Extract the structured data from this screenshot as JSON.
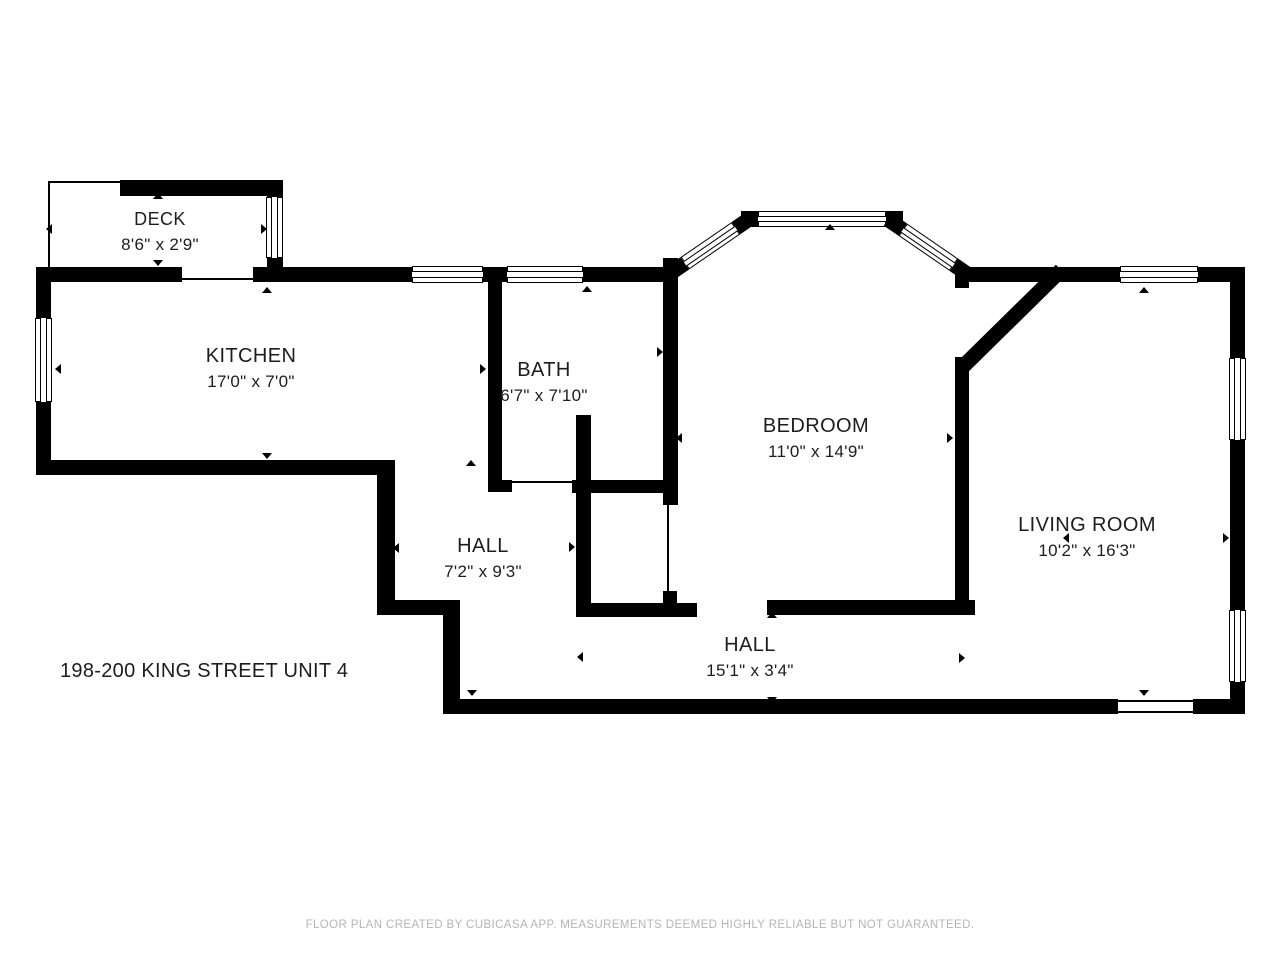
{
  "floor_plan": {
    "address": "198-200 KING STREET UNIT 4",
    "footer": "FLOOR PLAN CREATED BY CUBICASA APP. MEASUREMENTS DEEMED HIGHLY RELIABLE BUT NOT GUARANTEED.",
    "rooms": [
      {
        "name": "DECK",
        "dimensions": "8'6\" x 2'9\""
      },
      {
        "name": "KITCHEN",
        "dimensions": "17'0\" x 7'0\""
      },
      {
        "name": "BATH",
        "dimensions": "6'7\" x 7'10\""
      },
      {
        "name": "BEDROOM",
        "dimensions": "11'0\" x 14'9\""
      },
      {
        "name": "LIVING ROOM",
        "dimensions": "10'2\" x 16'3\""
      },
      {
        "name": "HALL",
        "dimensions": "7'2\" x 9'3\""
      },
      {
        "name": "HALL",
        "dimensions": "15'1\" x 3'4\""
      }
    ],
    "colors": {
      "wall": "#000000",
      "background": "#ffffff",
      "label_text": "#1d1d1d",
      "footer_text": "#b5b5b5"
    }
  }
}
